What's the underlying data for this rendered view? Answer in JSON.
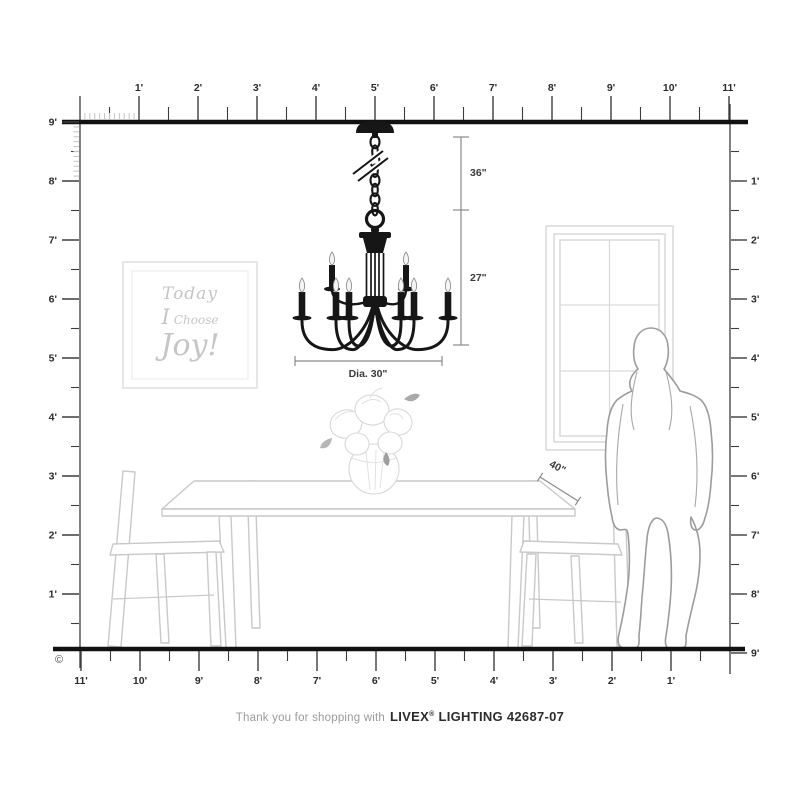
{
  "page": {
    "copyright_symbol": "©",
    "footer": {
      "prefix": "Thank you for shopping with",
      "brand": "LIVEX",
      "registered_mark": "®",
      "product": "LIGHTING 42687-07"
    }
  },
  "rulers": {
    "top": {
      "labels": [
        "1'",
        "2'",
        "3'",
        "4'",
        "5'",
        "6'",
        "7'",
        "8'",
        "9'",
        "10'",
        "11'"
      ]
    },
    "left": {
      "labels": [
        "9'",
        "8'",
        "7'",
        "6'",
        "5'",
        "4'",
        "3'",
        "2'",
        "1'"
      ]
    },
    "right": {
      "labels": [
        "1'",
        "2'",
        "3'",
        "4'",
        "5'",
        "6'",
        "7'",
        "8'",
        "9'"
      ]
    },
    "bottom": {
      "labels": [
        "11'",
        "10'",
        "9'",
        "8'",
        "7'",
        "6'",
        "5'",
        "4'",
        "3'",
        "2'",
        "1'"
      ]
    }
  },
  "dimensions": {
    "chain_length": "36\"",
    "fixture_height": "27\"",
    "fixture_diameter": "Dia. 30\"",
    "table_depth": "40\""
  },
  "artwork": {
    "line1": "Today",
    "line2_word1": "I",
    "line2_word2": "Choose",
    "line3": "Joy!"
  },
  "colors": {
    "ink": "#161616",
    "sketch": "#c9c9c9",
    "dim_line": "#8a8a8a",
    "ruler": "#3d3d3d",
    "art_text": "#c6c6c6"
  }
}
